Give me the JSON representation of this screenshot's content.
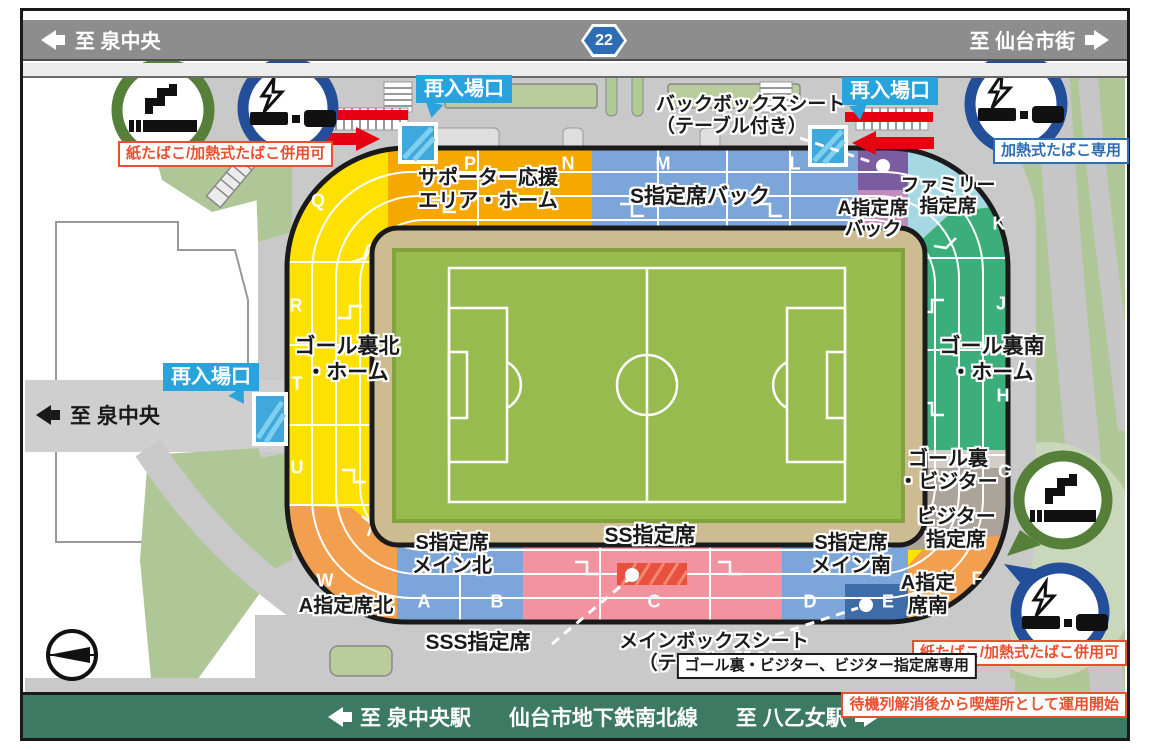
{
  "top_bar": {
    "left": "至 泉中央",
    "route_number": "22",
    "right": "至 仙台市街"
  },
  "bottom_bar": {
    "left": "至 泉中央駅",
    "center": "仙台市地下鉄南北線",
    "right": "至 八乙女駅"
  },
  "left_road_label": "至 泉中央",
  "labels": {
    "reentry": "再入場口"
  },
  "sections": {
    "supporter_line1": "サポーター応援",
    "supporter_line2": "エリア・ホーム",
    "s_back": "S指定席バック",
    "a_back_line1": "A指定席",
    "a_back_line2": "バック",
    "family_line1": "ファミリー",
    "family_line2": "指定席",
    "goal_north_line1": "ゴール裏北",
    "goal_north_line2": "・ホーム",
    "goal_south_line1": "ゴール裏南",
    "goal_south_line2": "・ホーム",
    "goal_visitor_line1": "ゴール裏",
    "goal_visitor_line2": "・ビジター",
    "visitor_line1": "ビジター",
    "visitor_line2": "指定席",
    "a_south_line1": "A指定",
    "a_south_line2": "席南",
    "a_north": "A指定席北",
    "s_main_north_line1": "S指定席",
    "s_main_north_line2": "メイン北",
    "ss": "SS指定席",
    "s_main_south_line1": "S指定席",
    "s_main_south_line2": "メイン南",
    "sss": "SSS指定席",
    "main_box_line1": "メインボックスシート",
    "main_box_line2": "（テーブル付き）",
    "back_box_line1": "バックボックスシート",
    "back_box_line2": "（テーブル付き）"
  },
  "blocks": [
    "P",
    "N",
    "M",
    "L",
    "Q",
    "R",
    "T",
    "U",
    "W",
    "K",
    "J",
    "H",
    "G",
    "F",
    "A",
    "B",
    "C",
    "D",
    "E"
  ],
  "smoking": {
    "both_ok_top": "紙たばこ/加熱式たばこ併用可",
    "heated_only": "加熱式たばこ専用",
    "both_ok_bottom": "紙たばこ/加熱式たばこ併用可",
    "visitor_only": "ゴール裏・ビジター、ビジター指定席専用",
    "note": "待機列解消後から喫煙所として運用開始"
  },
  "colors": {
    "goal_home_yellow": "#ffe100",
    "supporter_orange": "#f5a800",
    "seat_blue": "#7ca5d9",
    "seat_dark_blue": "#3e6ca8",
    "a_back_purple": "#7a5ca0",
    "a_back_mauve": "#c08bbc",
    "family_light_blue": "#a6d8e4",
    "goal_south_teal": "#3bae7c",
    "visitor_taupe": "#aba29a",
    "corner_orange": "#f2a04f",
    "ss_pink": "#f2939f",
    "sss_red": "#e8513d",
    "field_tan": "#cdbb92",
    "pitch_green": "#97bb4e",
    "road_gray": "#c9c9c9",
    "grass_green": "#afc797",
    "top_bar_gray": "#8d8d8d",
    "bottom_bar_green": "#3c7a64",
    "gate_blue": "#3fa8dc",
    "reentry_blue": "#29a3dc",
    "arrow_red": "#e60012",
    "sign_blue": "#2e6db4",
    "smoke_ring_green": "#567f39",
    "smoke_ring_blue": "#234f9a"
  }
}
